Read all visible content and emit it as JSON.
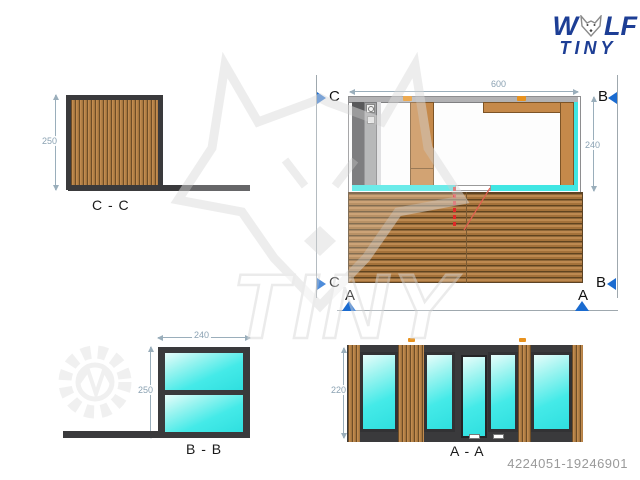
{
  "logo": {
    "line1_start": "W",
    "line1_end": "LF",
    "line2": "TINY",
    "color": "#1d3e95"
  },
  "footer": {
    "id_number": "4224051-19246901"
  },
  "views": {
    "cc": {
      "label": "C - C",
      "dim_height": "250"
    },
    "plan": {
      "dim_600": "600",
      "dim_580": "580",
      "dim_220": "220",
      "dim_240": "240",
      "marker_c": "C",
      "marker_b": "B",
      "marker_a": "A"
    },
    "bb": {
      "label": "B - B",
      "dim_width": "240",
      "dim_height": "250"
    },
    "aa": {
      "label": "A - A",
      "dim_height": "220"
    }
  },
  "colors": {
    "frame": "#3a3a3c",
    "wood": "#c28c50",
    "glass": "#40e6e3",
    "marker_blue": "#1a6bd0",
    "dim": "#9aaebb",
    "red": "#e02828",
    "orange": "#e8921e"
  }
}
